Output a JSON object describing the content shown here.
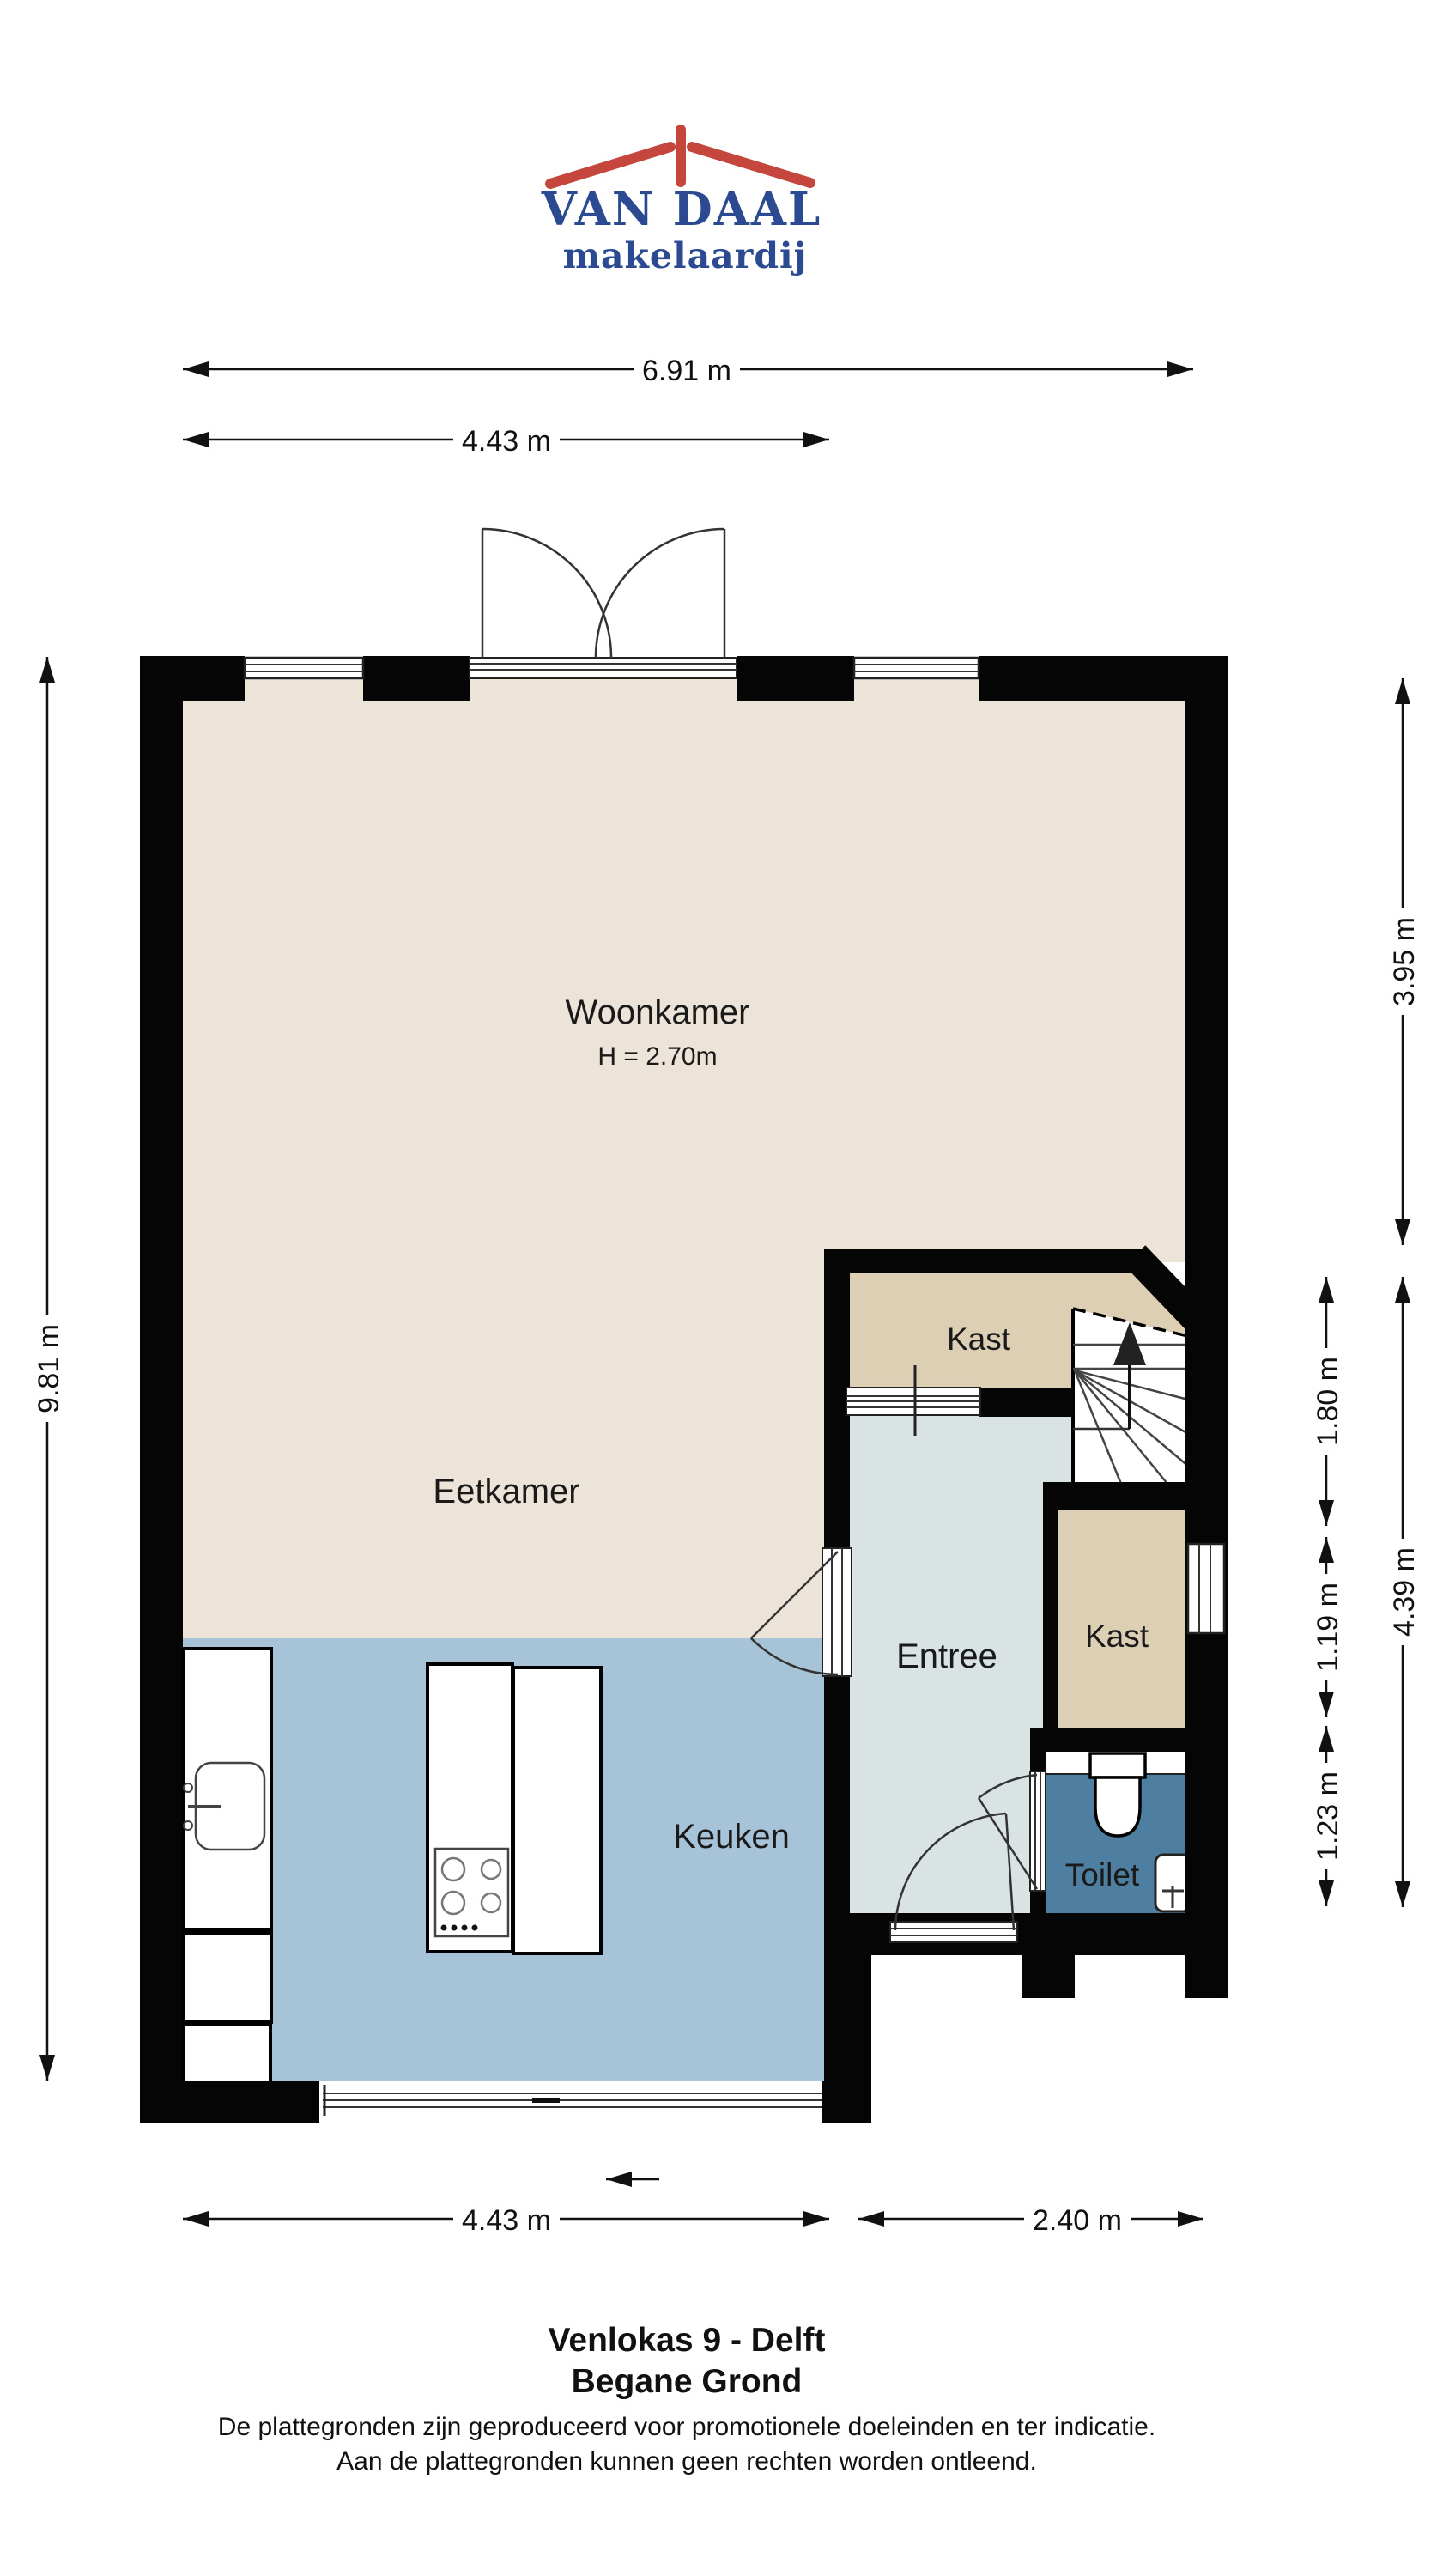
{
  "logo": {
    "name": "VAN DAAL",
    "tagline": "makelaardij"
  },
  "rooms": {
    "woonkamer": {
      "label": "Woonkamer",
      "ceiling": "H = 2.70m"
    },
    "eetkamer": {
      "label": "Eetkamer"
    },
    "keuken": {
      "label": "Keuken"
    },
    "entree": {
      "label": "Entree"
    },
    "kast_boven": {
      "label": "Kast"
    },
    "kast_onder": {
      "label": "Kast"
    },
    "toilet": {
      "label": "Toilet"
    }
  },
  "dimensions": {
    "top_total": "6.91 m",
    "top_left": "4.43 m",
    "left_total": "9.81 m",
    "right_upper": "3.95 m",
    "right_lower": "4.39 m",
    "right_inner_top": "1.80 m",
    "right_inner_mid": "1.19 m",
    "right_inner_bottom": "1.23 m",
    "bottom_left": "4.43 m",
    "bottom_right": "2.40 m"
  },
  "footer": {
    "title": "Venlokas 9 - Delft",
    "subtitle": "Begane Grond",
    "disclaimer_line1": "De plattegronden zijn geproduceerd voor promotionele doeleinden en ter indicatie.",
    "disclaimer_line2": "Aan de plattegronden kunnen geen rechten worden ontleend."
  },
  "colors": {
    "wall": "#050505",
    "woonkamer_floor": "#ECE4D8",
    "keuken_floor": "#A6C3D8",
    "entree_floor": "#DAE3E3",
    "kast_floor": "#DCCFB4",
    "toilet_floor": "#4E7FA0",
    "logo_blue": "#2B4A91",
    "logo_red": "#C5463D"
  }
}
